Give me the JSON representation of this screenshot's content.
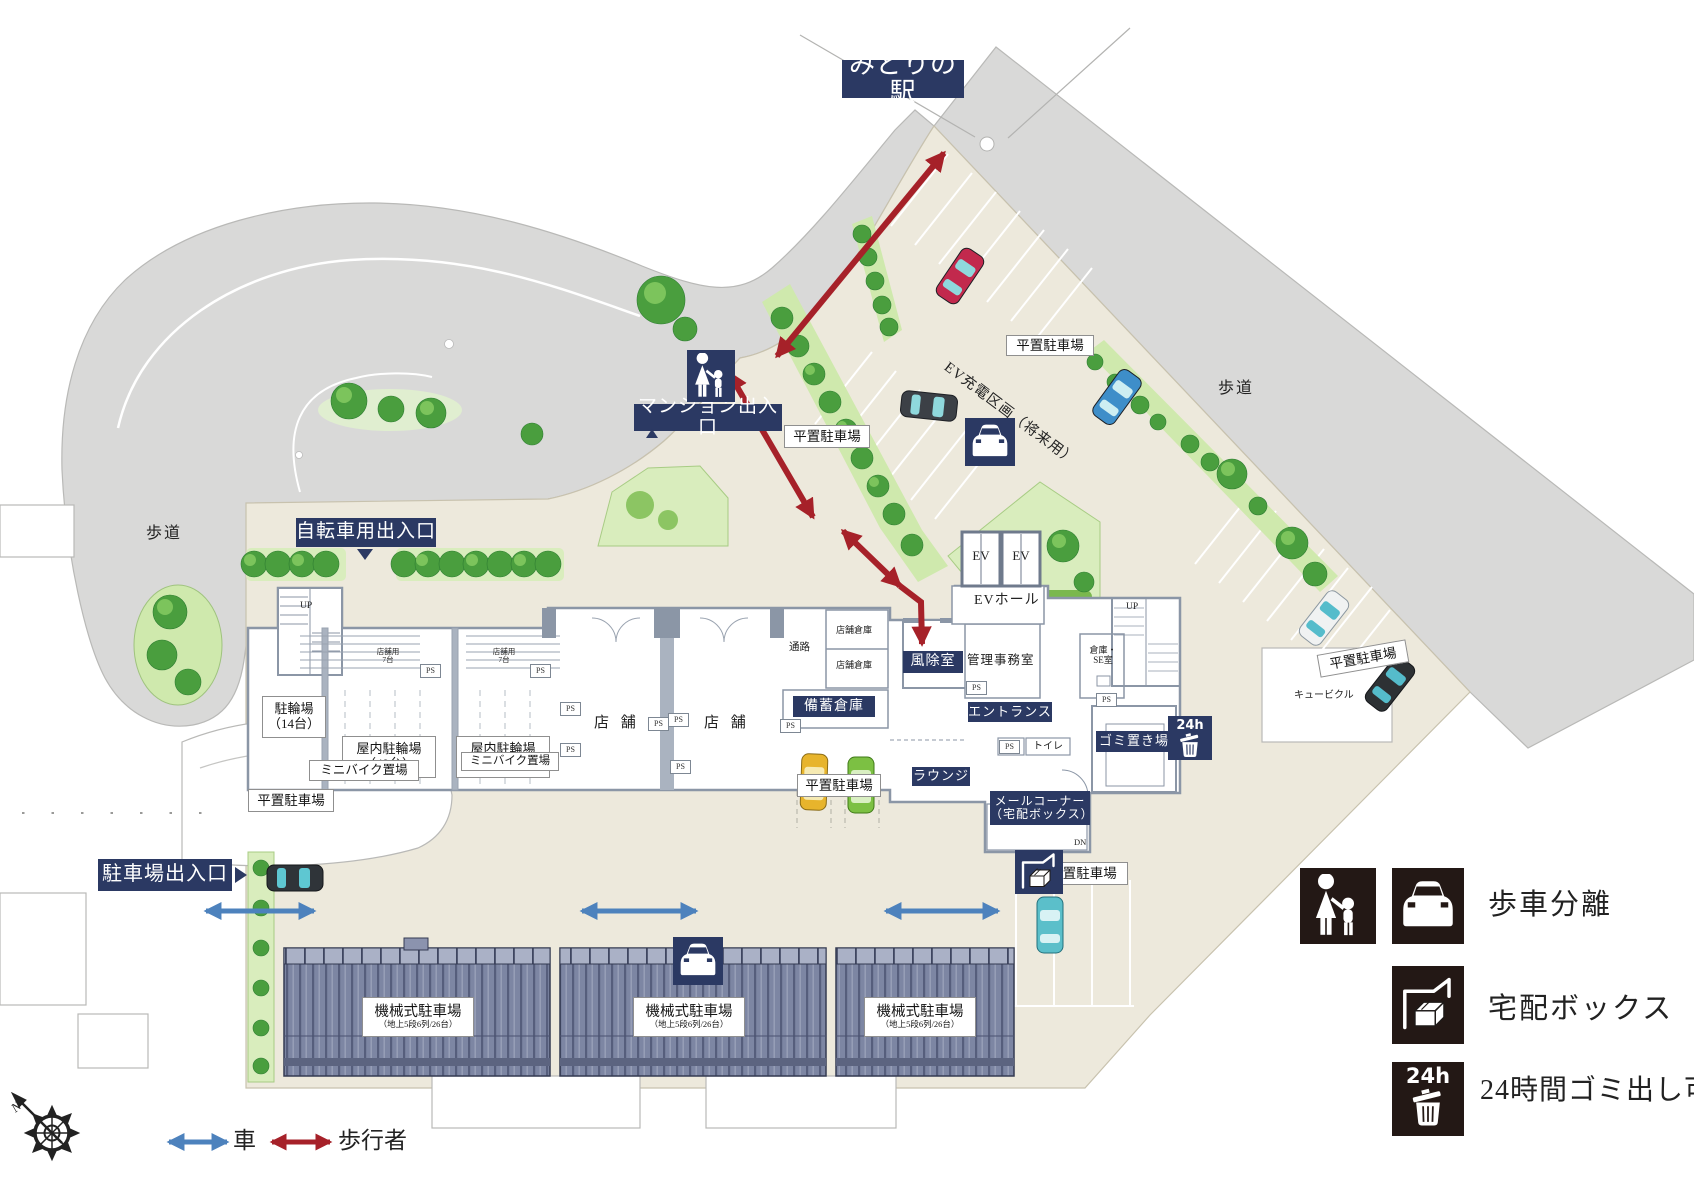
{
  "colors": {
    "navy": "#2b3963",
    "pedestrian_arrow_red": "#a62129",
    "vehicle_arrow_blue": "#4d82bd",
    "site_beige": "#ede9dc",
    "road_gray": "#d9d9d8",
    "building_wall_gray": "#8b96a6",
    "legend_icon_dark": "#231815",
    "greenery": "#4a9e3e"
  },
  "map": {
    "station": "みどりの駅",
    "sidewalk": "歩道",
    "mansion_entrance": "マンション出入口",
    "bicycle_entrance": "自転車用出入口",
    "parking_entrance": "駐車場出入口",
    "flat_parking": "平置駐車場",
    "ev_charging_zone": "EV充電区画（将来用）",
    "mechanical_parking": "機械式駐車場",
    "mechanical_parking_spec": "（地上5段6列/26台）",
    "bicycle_parking": "駐輪場",
    "bicycle_parking_count": "（14台）",
    "indoor_bicycle_parking": "屋内駐輪場",
    "indoor_count_49": "（49台）",
    "indoor_count_55": "（55台）",
    "minibike_area": "ミニバイク置場",
    "store_use": "店舗用",
    "store_use_count": "7台",
    "store": "店 舗",
    "passage": "通路",
    "store_warehouse": "店舗倉庫",
    "stockpile_warehouse": "備蓄倉庫",
    "windbreak_room": "風除室",
    "elevator": "EV",
    "ev_hall": "EVホール",
    "admin_office": "管理事務室",
    "entrance_hall": "エントランス",
    "lounge": "ラウンジ",
    "mail_corner": "メールコーナー",
    "mail_corner_sub": "（宅配ボックス）",
    "warehouse_se_1": "倉庫・",
    "warehouse_se_2": "SE室",
    "toilet": "トイレ",
    "pipe_space": "PS",
    "garbage_area": "ゴミ置き場",
    "cubicle": "キュービクル",
    "up": "UP",
    "dn": "DN",
    "h24": "24h",
    "north": "N"
  },
  "legend": {
    "walk_car_separation": "歩車分離",
    "delivery_box": "宅配ボックス",
    "garbage_24h": "24時間ゴミ出し可",
    "car": "車",
    "pedestrian": "歩行者"
  },
  "icons": [
    "pedestrian-icon",
    "car-icon",
    "delivery-box-icon",
    "24h-garbage-icon",
    "compass-icon",
    "right-triangle-icon",
    "down-triangle-icon",
    "up-triangle-icon"
  ]
}
